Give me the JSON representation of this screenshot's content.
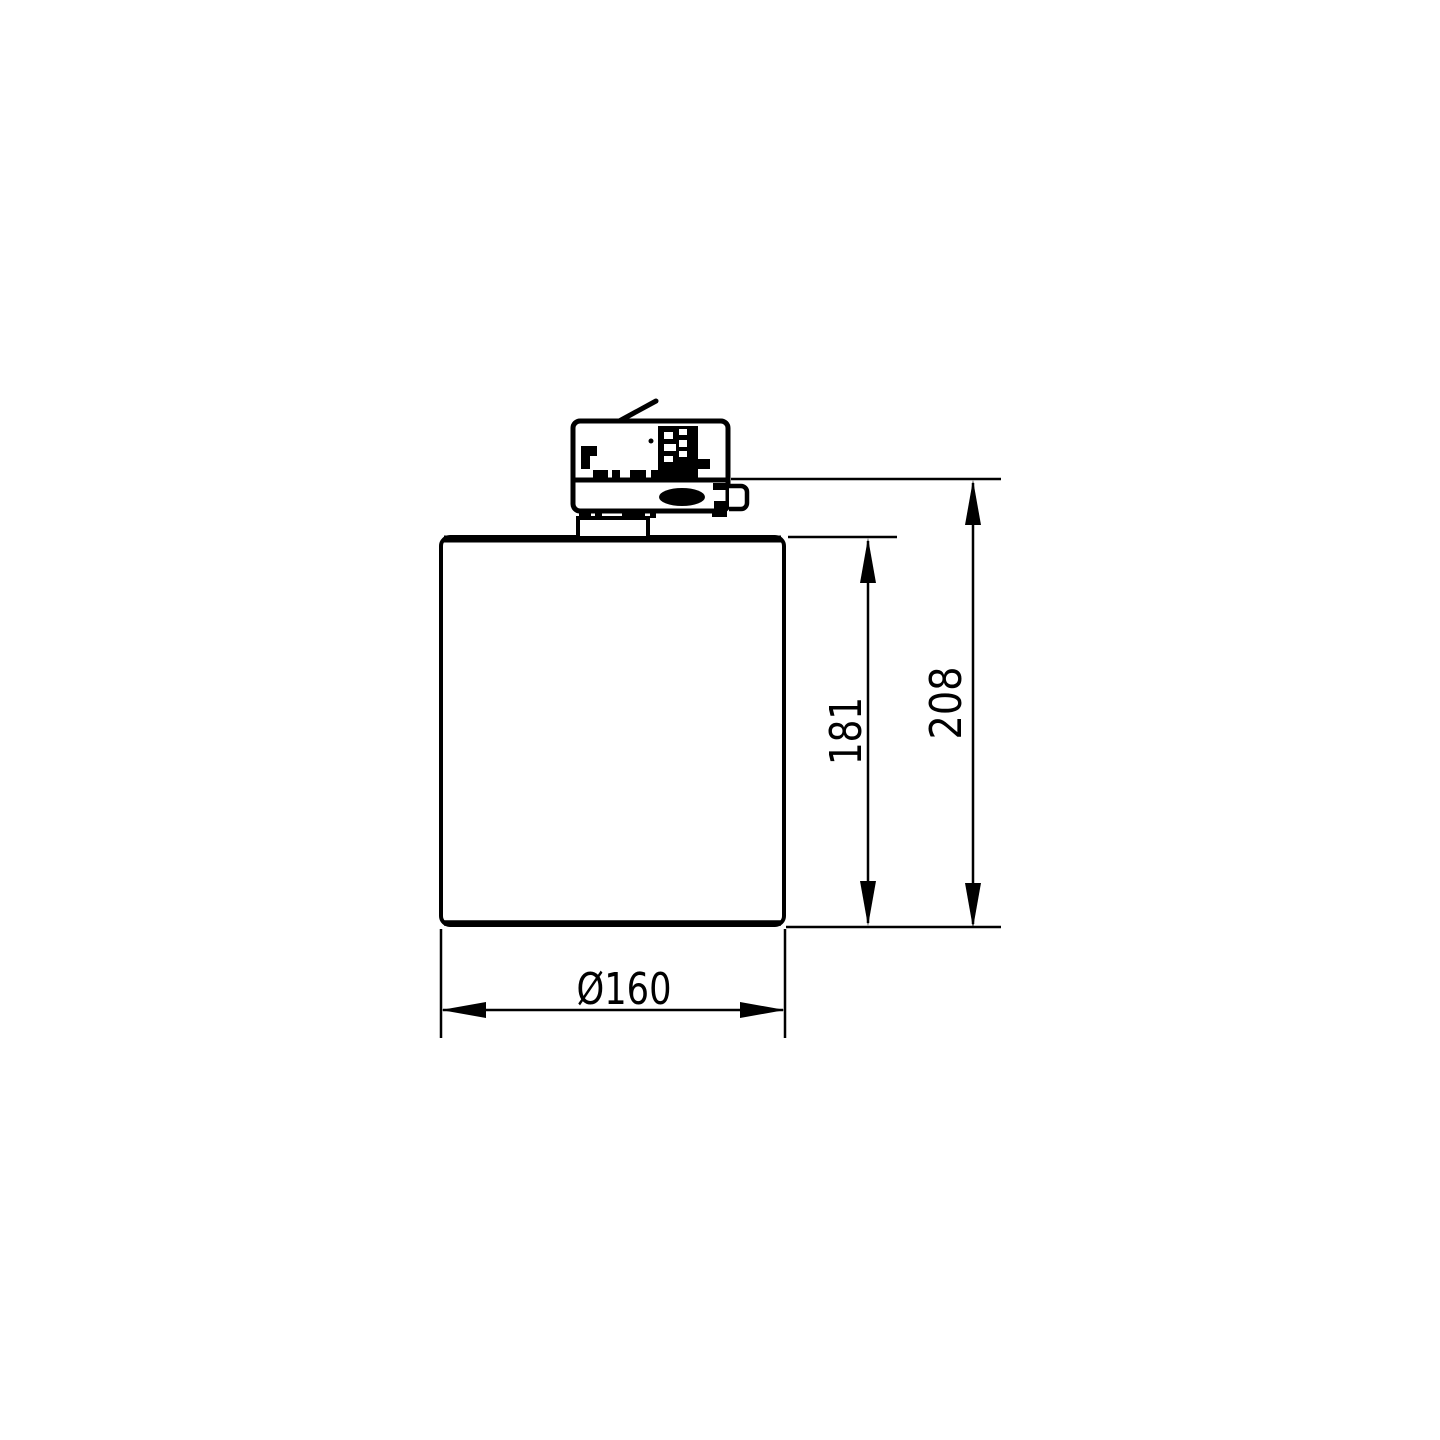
{
  "page": {
    "background_color": "#ffffff",
    "line_color": "#000000"
  },
  "drawing": {
    "type": "technical-dimension-drawing",
    "subject": "track-mounted spotlight, side elevation with track adapter",
    "labels": {
      "body_height": "181",
      "total_height": "208",
      "diameter": "Ø160"
    }
  }
}
